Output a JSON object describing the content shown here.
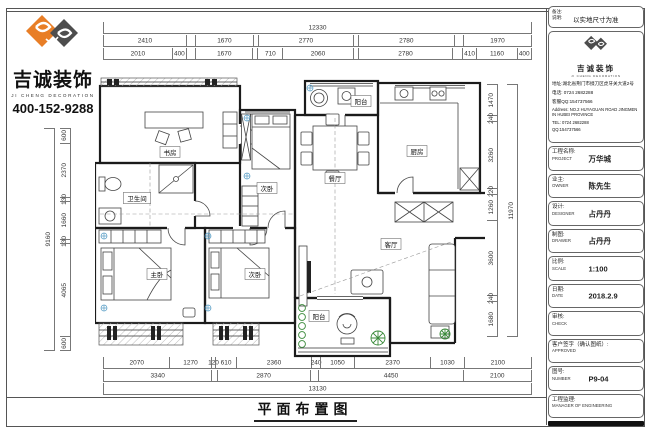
{
  "brand": {
    "name_cn": "吉诚装饰",
    "name_en": "JI CHENG DECORATION",
    "phone": "400-152-9288",
    "logo_orange": "#e87e26",
    "logo_gray": "#4d4d4d"
  },
  "drawing": {
    "title": "平面布置图"
  },
  "dims": {
    "top": {
      "overall": [
        {
          "v": 12330,
          "t": "12330"
        }
      ],
      "row2": [
        {
          "v": 2410,
          "t": "2410"
        },
        {
          "v": 240,
          "t": ""
        },
        {
          "v": 1670,
          "t": "1670"
        },
        {
          "v": 120,
          "t": ""
        },
        {
          "v": 2770,
          "t": "2770"
        },
        {
          "v": 120,
          "t": ""
        },
        {
          "v": 2780,
          "t": "2780"
        },
        {
          "v": 250,
          "t": ""
        },
        {
          "v": 1970,
          "t": "1970"
        }
      ],
      "row3": [
        {
          "v": 2010,
          "t": "2010"
        },
        {
          "v": 400,
          "t": "400"
        },
        {
          "v": 240,
          "t": ""
        },
        {
          "v": 1670,
          "t": "1670"
        },
        {
          "v": 120,
          "t": ""
        },
        {
          "v": 710,
          "t": "710"
        },
        {
          "v": 2060,
          "t": "2060"
        },
        {
          "v": 120,
          "t": ""
        },
        {
          "v": 2780,
          "t": "2780"
        },
        {
          "v": 250,
          "t": ""
        },
        {
          "v": 410,
          "t": "410"
        },
        {
          "v": 1160,
          "t": "1160"
        },
        {
          "v": 400,
          "t": "400"
        }
      ]
    },
    "bottom": {
      "row1": [
        {
          "v": 2070,
          "t": "2070"
        },
        {
          "v": 1270,
          "t": "1270"
        },
        {
          "v": 120,
          "t": "120"
        },
        {
          "v": 610,
          "t": "610"
        },
        {
          "v": 2360,
          "t": "2360"
        },
        {
          "v": 240,
          "t": "240"
        },
        {
          "v": 1050,
          "t": "1050"
        },
        {
          "v": 2370,
          "t": "2370"
        },
        {
          "v": 1030,
          "t": "1030"
        },
        {
          "v": 2100,
          "t": "2100"
        }
      ],
      "row2": [
        {
          "v": 3340,
          "t": "3340"
        },
        {
          "v": 130,
          "t": ""
        },
        {
          "v": 2870,
          "t": "2870"
        },
        {
          "v": 240,
          "t": ""
        },
        {
          "v": 4450,
          "t": "4450"
        },
        {
          "v": 2100,
          "t": "2100"
        }
      ],
      "overall": [
        {
          "v": 13130,
          "t": "13130"
        }
      ]
    },
    "left": {
      "overall": [
        {
          "v": 9160,
          "t": "9160"
        }
      ],
      "segs": [
        {
          "v": 600,
          "t": "600"
        },
        {
          "v": 2370,
          "t": "2370"
        },
        {
          "v": 130,
          "t": "130"
        },
        {
          "v": 1660,
          "t": "1660"
        },
        {
          "v": 130,
          "t": "130"
        },
        {
          "v": 4065,
          "t": "4065"
        },
        {
          "v": 600,
          "t": "600"
        }
      ]
    },
    "right": {
      "segs": [
        {
          "v": 1470,
          "t": "1470"
        },
        {
          "v": 240,
          "t": "240"
        },
        {
          "v": 3260,
          "t": "3260"
        },
        {
          "v": 220,
          "t": "220"
        },
        {
          "v": 1260,
          "t": "1260"
        },
        {
          "v": 3600,
          "t": "3600"
        },
        {
          "v": 240,
          "t": "240"
        },
        {
          "v": 1680,
          "t": "1680"
        }
      ],
      "overall": [
        {
          "v": 11970,
          "t": "11970"
        }
      ]
    }
  },
  "plan": {
    "rooms": [
      {
        "label": "书房",
        "x": 75,
        "y": 96
      },
      {
        "label": "阳台",
        "x": 266,
        "y": 45
      },
      {
        "label": "次卧",
        "x": 172,
        "y": 132
      },
      {
        "label": "厨房",
        "x": 322,
        "y": 95
      },
      {
        "label": "餐厅",
        "x": 240,
        "y": 122
      },
      {
        "label": "客厅",
        "x": 296,
        "y": 188
      },
      {
        "label": "卫生间",
        "x": 42,
        "y": 142
      },
      {
        "label": "主卧",
        "x": 62,
        "y": 218
      },
      {
        "label": "次卧",
        "x": 160,
        "y": 218
      },
      {
        "label": "阳台",
        "x": 224,
        "y": 260
      }
    ]
  },
  "titleblock": {
    "note": {
      "label1": "备注:",
      "label2": "说明:",
      "value": "以实地尺寸为准"
    },
    "company": {
      "addr_cn": "地址:湖北省荆门市掇刀区虎牙关大道2号",
      "tel_cn": "电话: 0724 2682288",
      "qq_cn": "客服QQ:154737566",
      "addr_en": "Address: NO.2 HUYAGUAN ROAD JINGMEN IN HUBEI PROVINCE",
      "tel_en": "TEL: 0724 2682288",
      "qq_en": "QQ:154737566"
    },
    "rows": [
      {
        "cn": "工程名称:",
        "en": "PROJECT",
        "value": "万华城"
      },
      {
        "cn": "业主:",
        "en": "OWNER",
        "value": "陈先生"
      },
      {
        "cn": "设计:",
        "en": "DESIGNER",
        "value": "占丹丹"
      },
      {
        "cn": "制图:",
        "en": "DRAWER",
        "value": "占丹丹"
      },
      {
        "cn": "比例:",
        "en": "SCALE",
        "value": "1:100"
      },
      {
        "cn": "日期:",
        "en": "DATE",
        "value": "2018.2.9"
      },
      {
        "cn": "审核:",
        "en": "CHECK",
        "value": ""
      },
      {
        "cn": "客户签字（确认图纸）:",
        "en": "APPROVED",
        "value": ""
      },
      {
        "cn": "图号:",
        "en": "NUMBER",
        "value": "P9-04"
      },
      {
        "cn": "工程监理:",
        "en": "MANAGER OF ENGINEERING",
        "value": ""
      }
    ]
  }
}
